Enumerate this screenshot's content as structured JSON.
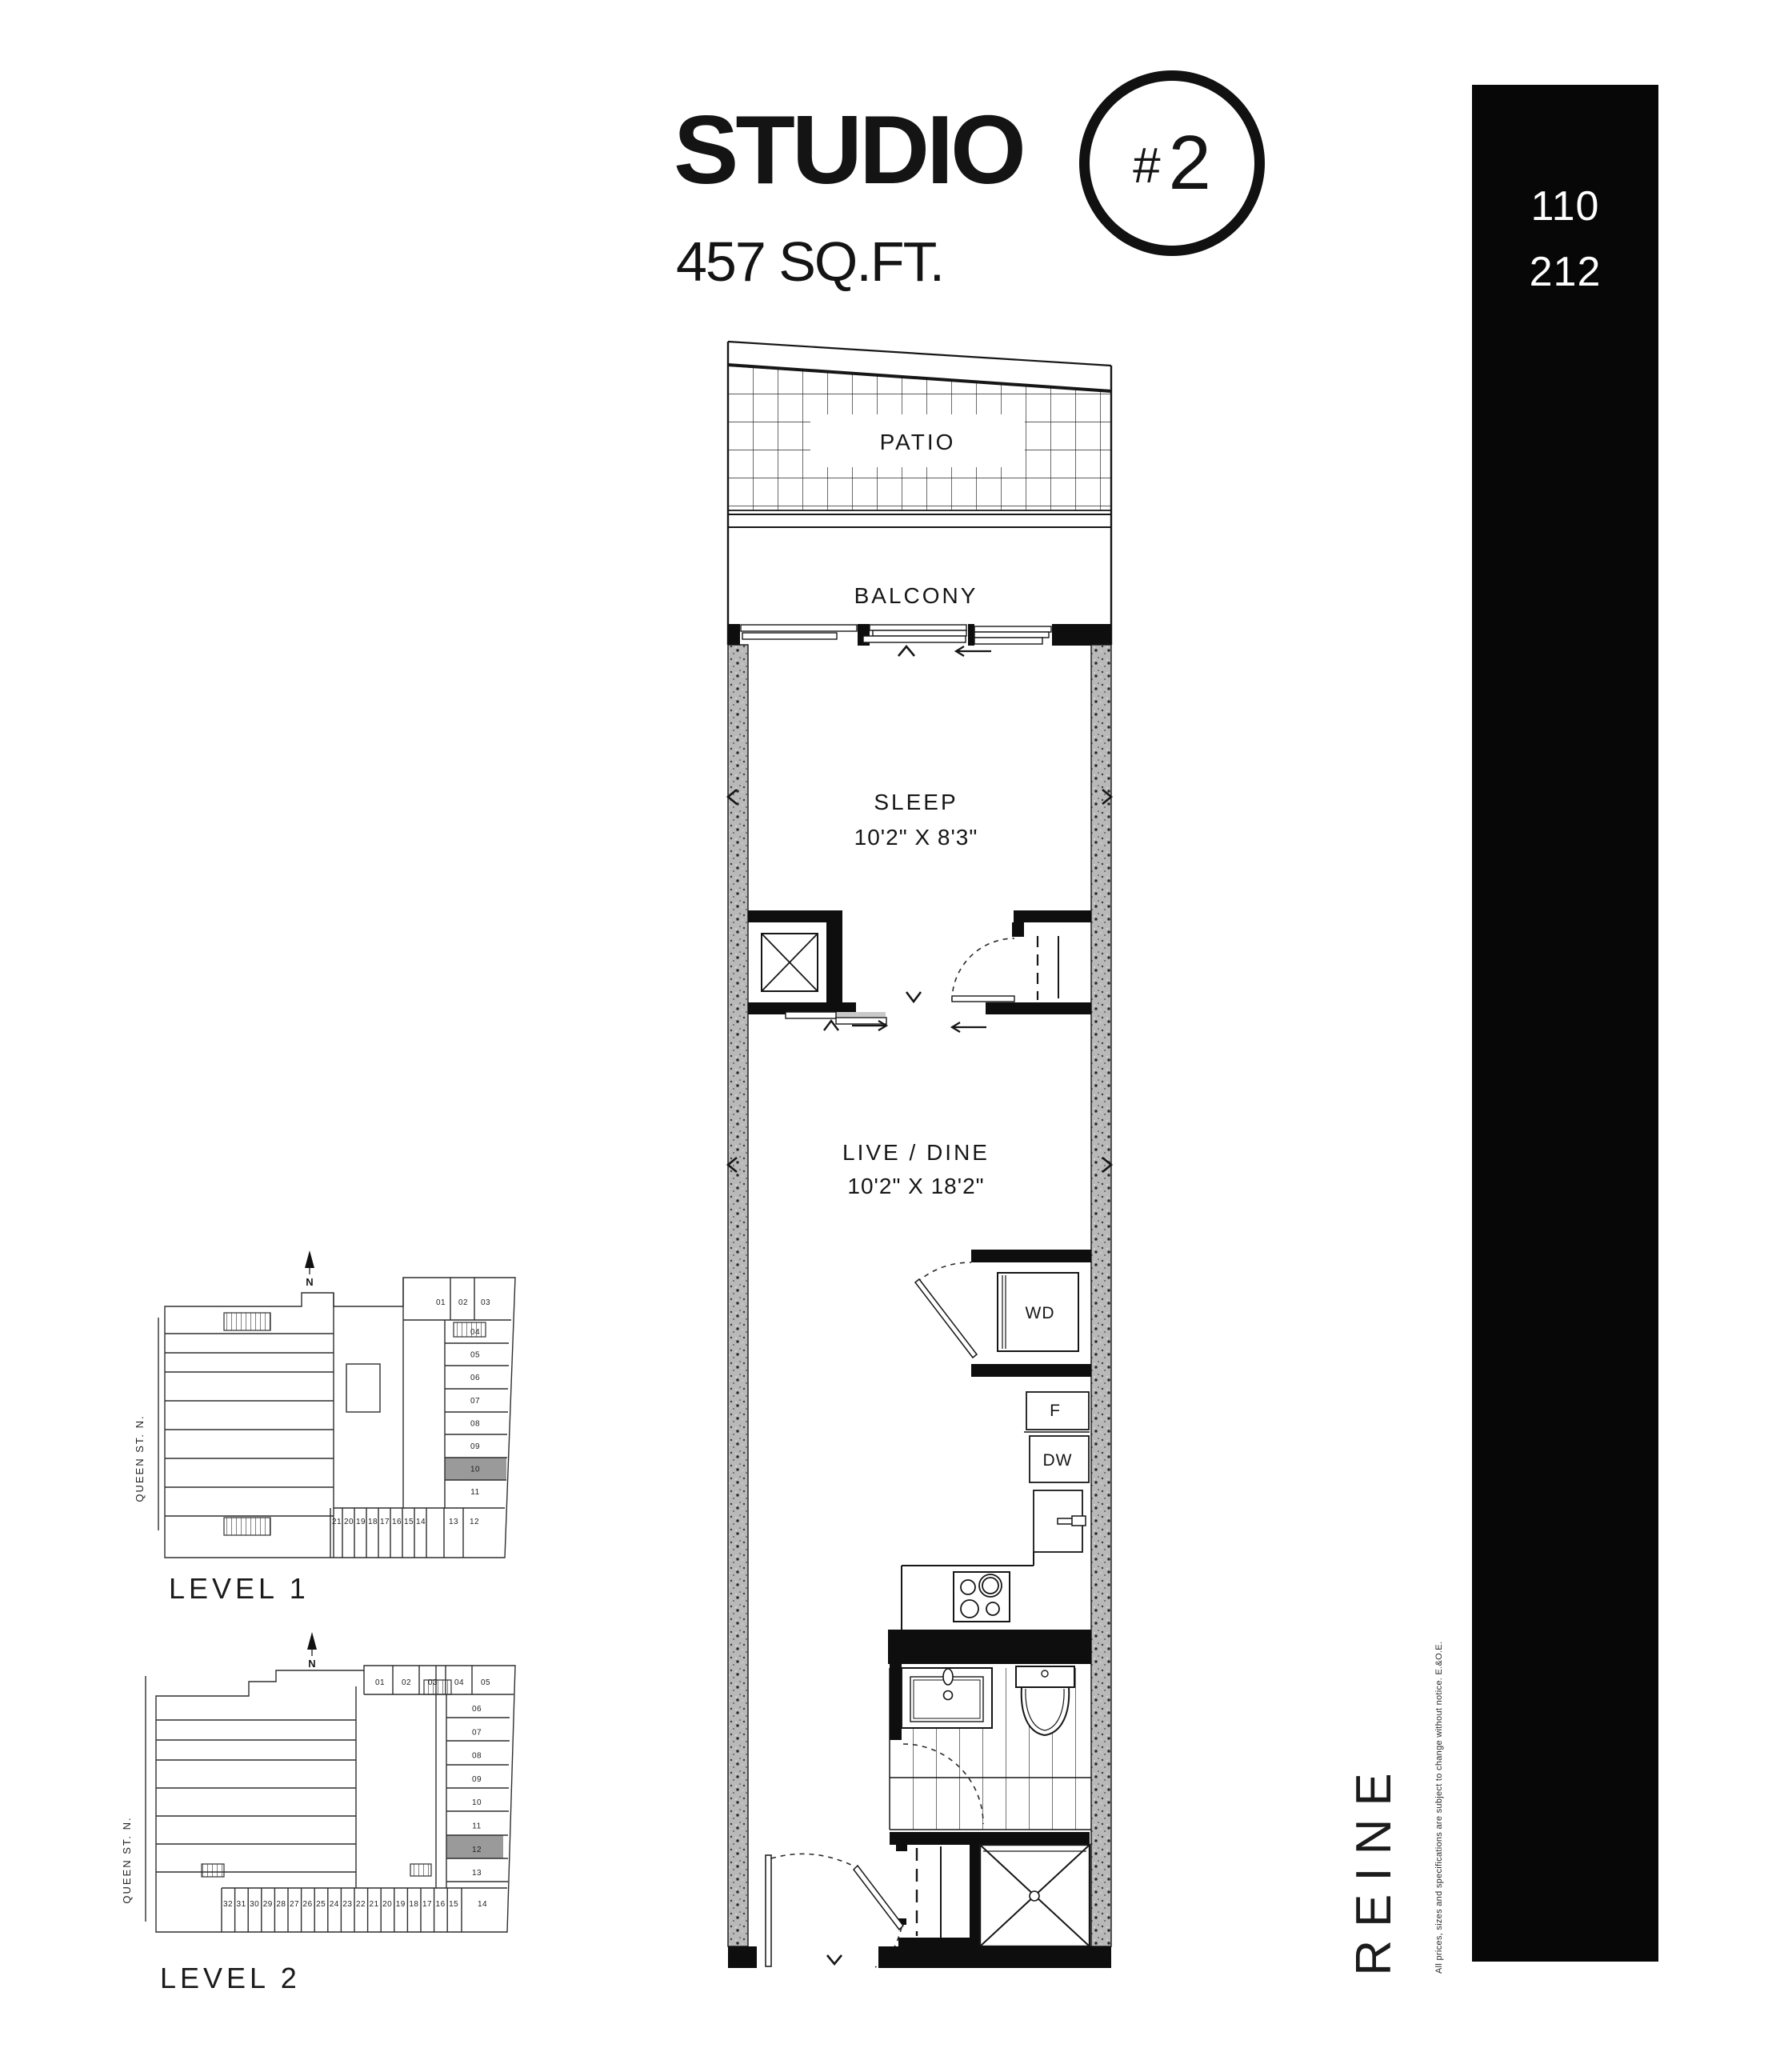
{
  "header": {
    "title": "STUDIO",
    "badge_hash": "#",
    "badge_num": "2",
    "area": "457 SQ.FT."
  },
  "unit_bar": {
    "numbers": [
      "110",
      "212"
    ]
  },
  "floorplan": {
    "patio": "PATIO",
    "balcony": "BALCONY",
    "sleep_name": "SLEEP",
    "sleep_dims": "10'2\" X 8'3\"",
    "live_name": "LIVE / DINE",
    "live_dims": "10'2\" X 18'2\"",
    "washer_dryer": "WD",
    "fridge": "F",
    "dishwasher": "DW"
  },
  "keyplans": {
    "street": "QUEEN ST. N.",
    "north": "N",
    "level1": {
      "label": "LEVEL 1",
      "top_units": [
        "01",
        "02",
        "03"
      ],
      "right_units": [
        "04",
        "05",
        "06",
        "07",
        "08",
        "09",
        "10",
        "11"
      ],
      "corner_units": [
        "13",
        "12"
      ],
      "bottom_units": [
        "21",
        "20",
        "19",
        "18",
        "17",
        "16",
        "15",
        "14"
      ],
      "highlighted_unit": "10"
    },
    "level2": {
      "label": "LEVEL 2",
      "top_units": [
        "01",
        "02",
        "03",
        "04",
        "05"
      ],
      "right_units": [
        "06",
        "07",
        "08",
        "09",
        "10",
        "11",
        "12",
        "13"
      ],
      "bottom_units": [
        "32",
        "31",
        "30",
        "29",
        "28",
        "27",
        "26",
        "25",
        "24",
        "23",
        "22",
        "21",
        "20",
        "19",
        "18",
        "17",
        "16",
        "15"
      ],
      "corner_units": [
        "14"
      ],
      "highlighted_unit": "12"
    }
  },
  "branding": {
    "logo": "REINE",
    "disclaimer": "All prices, sizes and specifications are subject to change without notice. E.&O.E."
  },
  "colors": {
    "ink": "#141414",
    "wall_gray": "#b9b9b9",
    "unit_highlight": "#9a9a9a",
    "bar_bg": "#070707",
    "bar_text": "#ffffff"
  }
}
